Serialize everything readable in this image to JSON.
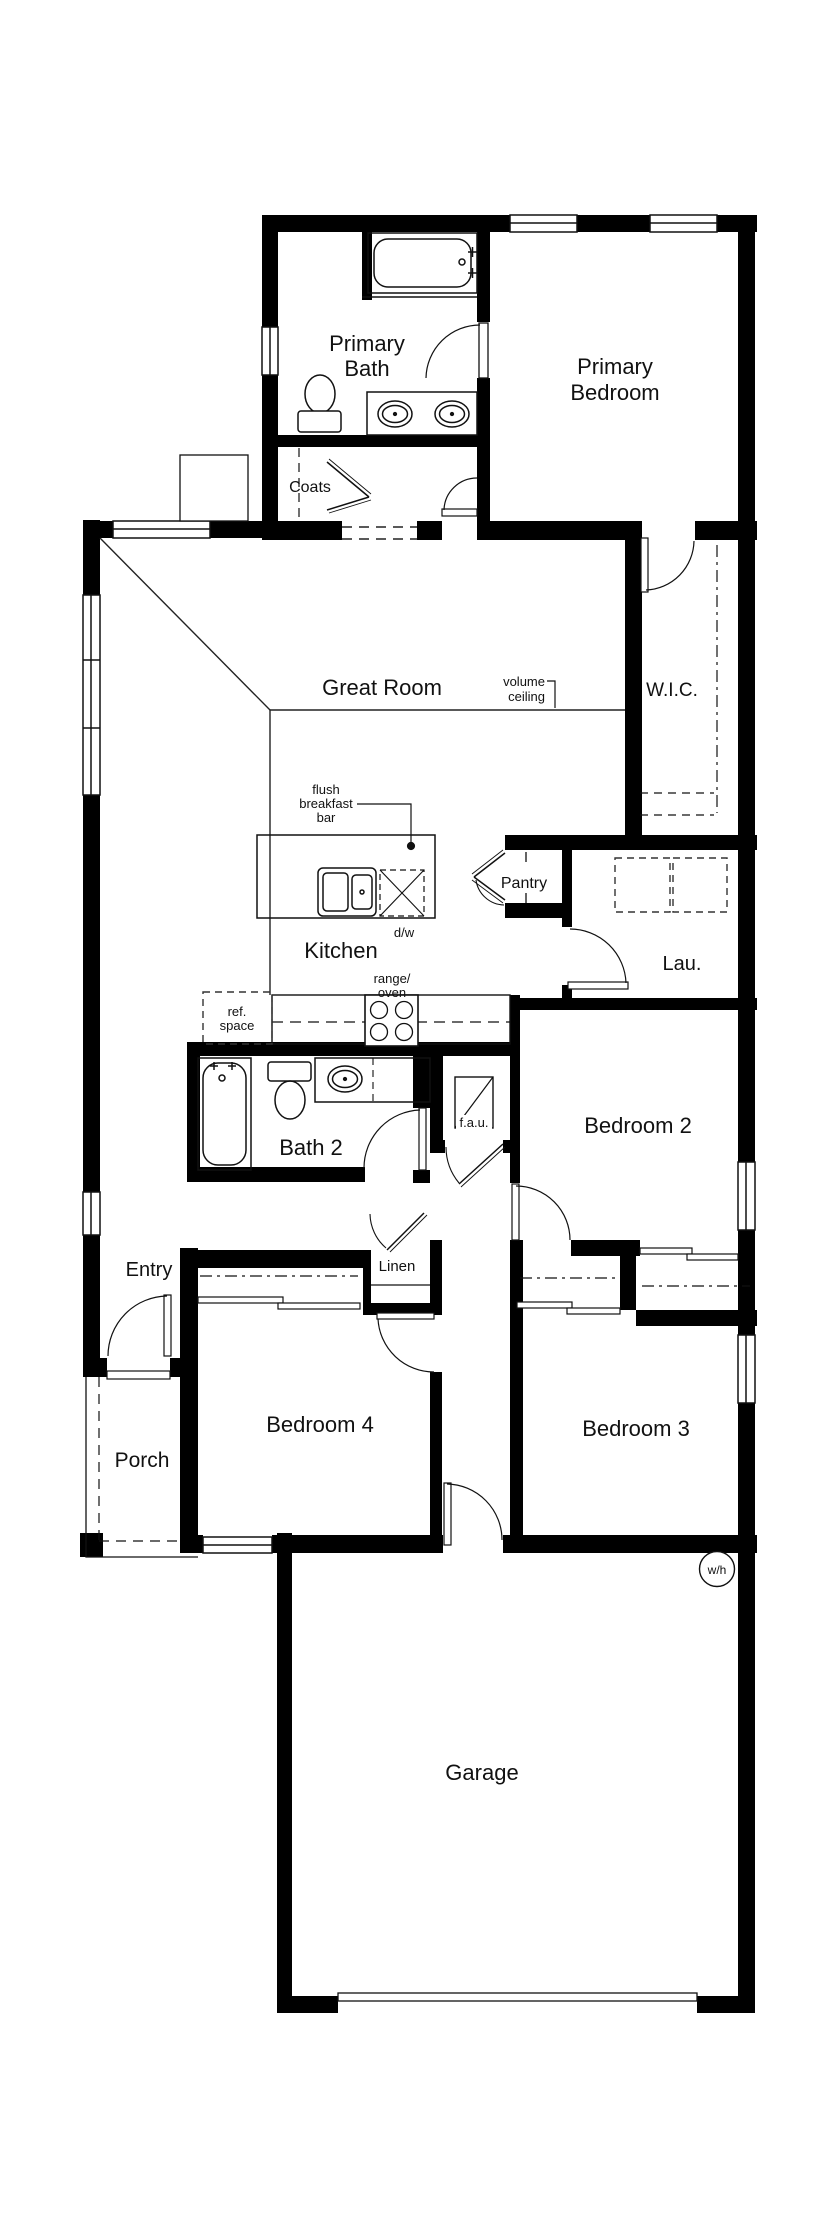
{
  "title": "floor-plan",
  "colors": {
    "wall": "#000000",
    "line": "#111111",
    "background": "#ffffff"
  },
  "labels": {
    "primary_bath": [
      "Primary",
      "Bath"
    ],
    "primary_bedroom": [
      "Primary",
      "Bedroom"
    ],
    "coats": "Coats",
    "great_room": "Great Room",
    "volume_ceiling": [
      "volume",
      "ceiling"
    ],
    "wic": "W.I.C.",
    "flush_breakfast_bar": [
      "flush",
      "breakfast",
      "bar"
    ],
    "pantry": "Pantry",
    "kitchen": "Kitchen",
    "dw": "d/w",
    "lau": "Lau.",
    "range_oven": [
      "range/",
      "oven"
    ],
    "ref_space": [
      "ref.",
      "space"
    ],
    "bath2": "Bath 2",
    "fau": "f.a.u.",
    "bedroom2": "Bedroom 2",
    "entry": "Entry",
    "linen": "Linen",
    "bedroom4": "Bedroom 4",
    "bedroom3": "Bedroom 3",
    "porch": "Porch",
    "garage": "Garage",
    "wh": "w/h"
  }
}
